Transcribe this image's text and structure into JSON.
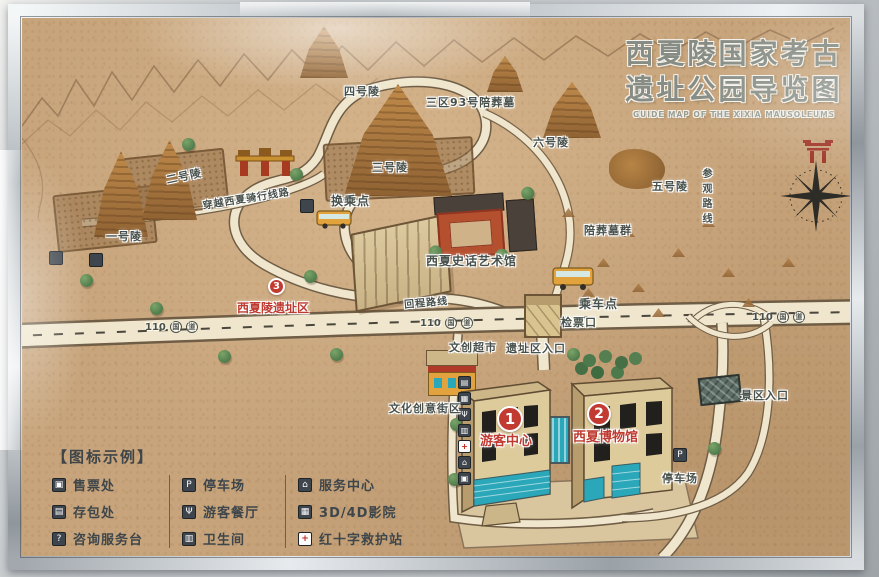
{
  "title": {
    "line1": "西夏陵国家考古",
    "line2": "遗址公园导览图",
    "subtitle": "GUIDE MAP OF THE XIXIA MAUSOLEUMS"
  },
  "sites": {
    "tomb1": "一号陵",
    "tomb2": "二号陵",
    "tomb3": "三号陵",
    "tomb4": "四号陵",
    "tomb5": "五号陵",
    "tomb6": "六号陵",
    "zone3_tomb93": "三区93号陪葬墓",
    "satellite_tombs": "陪葬墓群",
    "transfer_point": "换乘点",
    "history_art_hall": "西夏史话艺术馆",
    "return_route": "回程路线",
    "tour_route": "参观路线",
    "cycling_route": "穿越西夏骑行线路",
    "boarding_point": "乘车点",
    "ticket_gate": "检票口",
    "creative_supermarket": "文创超市",
    "site_entrance": "遗址区入口",
    "creative_street": "文化创意街区",
    "scenic_entrance": "景区入口",
    "parking": "停车场"
  },
  "highway": {
    "number": "110",
    "shield1": "国",
    "shield2": "道"
  },
  "markers": {
    "m1": {
      "num": "1",
      "label": "游客中心"
    },
    "m2": {
      "num": "2",
      "label": "西夏博物馆"
    },
    "m3": {
      "num": "3",
      "label": "西夏陵遗址区"
    }
  },
  "legend": {
    "header": "【图标示例】",
    "columns": [
      {
        "items": [
          {
            "icon": "ticket-office-icon",
            "glyph": "▣",
            "label": "售票处"
          },
          {
            "icon": "baggage-storage-icon",
            "glyph": "▤",
            "label": "存包处"
          },
          {
            "icon": "information-desk-icon",
            "glyph": "?",
            "label": "咨询服务台"
          }
        ]
      },
      {
        "items": [
          {
            "icon": "parking-icon",
            "glyph": "P",
            "label": "停车场"
          },
          {
            "icon": "restaurant-icon",
            "glyph": "Ψ",
            "label": "游客餐厅"
          },
          {
            "icon": "restroom-icon",
            "glyph": "▥",
            "label": "卫生间"
          }
        ]
      },
      {
        "items": [
          {
            "icon": "service-center-icon",
            "glyph": "⌂",
            "label": "服务中心"
          },
          {
            "icon": "cinema-icon",
            "glyph": "▦",
            "label": "3D/4D影院"
          },
          {
            "icon": "first-aid-icon",
            "glyph": "+",
            "label": "红十字救护站"
          }
        ]
      }
    ]
  },
  "facility_strip": {
    "glyphs": [
      "▤",
      "▦",
      "Ψ",
      "▥",
      "+",
      "⌂",
      "▣"
    ]
  },
  "badges": {
    "parking_glyph": "P"
  },
  "colors": {
    "map_bg": "#c7a47b",
    "road_fill": "#efe6cd",
    "road_edge": "#6f5d45",
    "red_accent": "#bf3a30",
    "label_ink": "#4a5048",
    "teal_glass": "#2aa7b8",
    "building_tan": "#dcc795",
    "mound_brown": "#a9763f",
    "tree_green": "#55804f",
    "frame_silver": "#c3c9cd"
  }
}
